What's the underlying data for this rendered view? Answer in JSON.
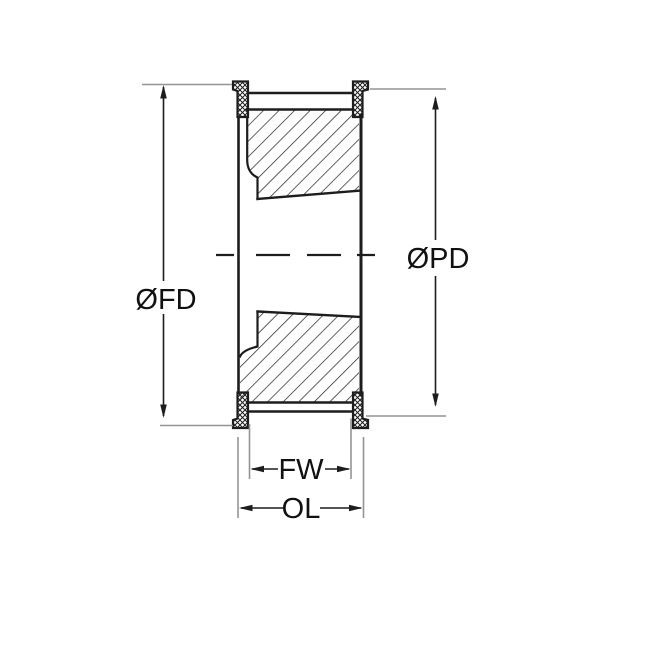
{
  "figure": {
    "labels": {
      "flange_diameter": "ØFD",
      "pitch_diameter": "ØPD",
      "face_width": "FW",
      "overall_length": "OL"
    },
    "colors": {
      "line": "#1d1d1d",
      "extension_line": "#949494",
      "background": "#ffffff"
    }
  }
}
